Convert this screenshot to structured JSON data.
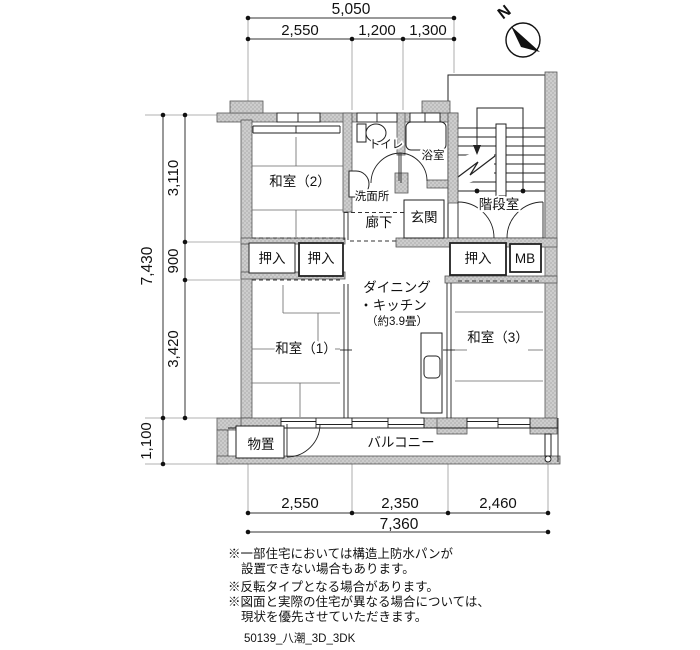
{
  "compass": {
    "label": "N"
  },
  "dimensions": {
    "top_total": "5,050",
    "top_segments": [
      "2,550",
      "1,200",
      "1,300"
    ],
    "left_total": "7,430",
    "left_segments": [
      "3,110",
      "900",
      "3,420"
    ],
    "left_balcony": "1,100",
    "bottom_segments": [
      "2,550",
      "2,350",
      "2,460"
    ],
    "bottom_total": "7,360"
  },
  "rooms": {
    "washitsu2": "和室（2）",
    "washitsu1": "和室（1）",
    "washitsu3": "和室（3）",
    "toilet": "トイレ",
    "bath": "浴室",
    "washroom": "洗面所",
    "hallway": "廊下",
    "entrance": "玄関",
    "stairwell": "階段室",
    "dk_line1": "ダイニング",
    "dk_line2": "・キッチン",
    "dk_line3": "（約3.9畳）",
    "oshiire": "押入",
    "mb": "MB",
    "storage": "物置",
    "balcony": "バルコニー"
  },
  "notes": [
    "※一部住宅においては構造上防水パンが",
    "設置できない場合もあります。",
    "※反転タイプとなる場合があります。",
    "※図面と実際の住宅が異なる場合については、",
    "現状を優先させていただきます。"
  ],
  "footer": "50139_八潮_3D_3DK",
  "colors": {
    "wall": "#cbcbcb",
    "line": "#2b2b2b"
  }
}
